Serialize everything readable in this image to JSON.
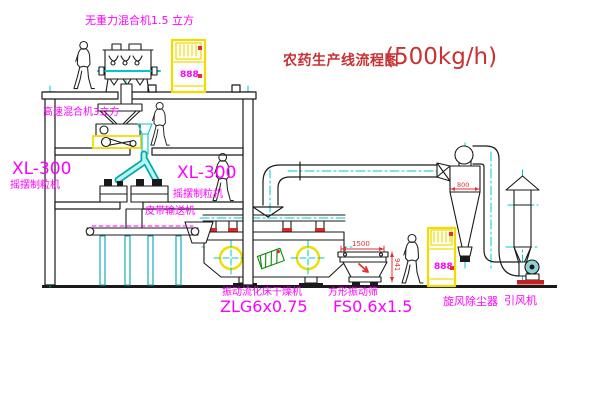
{
  "title": {
    "name": "农药生产线流程图",
    "capacity": "(500kg/h)"
  },
  "labels": {
    "gravity_mixer": "无重力混合机1.5 立方",
    "high_speed_mixer": "高速混合机3立方",
    "granulator_left": {
      "model": "XL-300",
      "name": "摇摆制粒机"
    },
    "granulator_mid": {
      "model": "XL-300",
      "name": "摇摆制粒机"
    },
    "belt_conveyor": "皮带输送机",
    "dryer": {
      "name": "振动流化床干燥机",
      "model": "ZLG6x0.75"
    },
    "sieve": {
      "name": "方形振动筛",
      "model": "FS0.6x1.5"
    },
    "cyclone": "旋风除尘器",
    "fan": "引风机"
  },
  "dimensions": {
    "sieve_length": "1500",
    "sieve_height": "941",
    "cyclone_diameter": "800"
  },
  "cabinets": {
    "top_display": "888",
    "right_display": "888"
  },
  "colors": {
    "label_magenta": "#ff00ff",
    "title_red": "#c83232",
    "centerline_cyan": "#00c8c8",
    "cabinet_yellow": "#f0dc00",
    "dimension_red": "#e03030",
    "line_black": "#1a1a1a"
  }
}
